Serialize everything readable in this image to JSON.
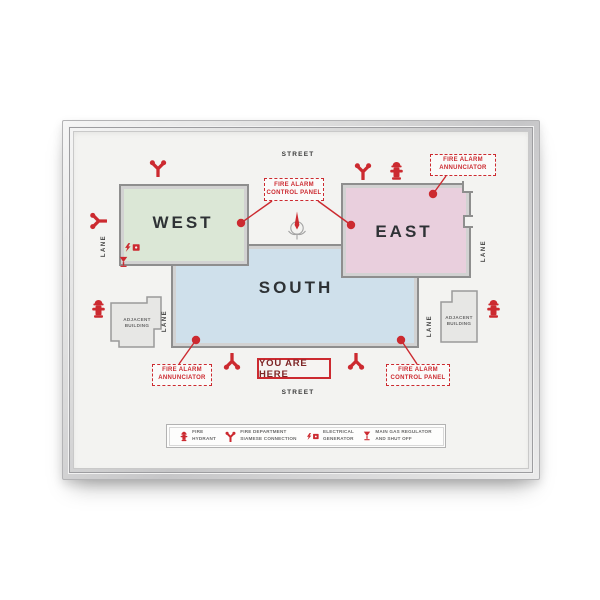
{
  "poster": {
    "streets": {
      "top": "STREET",
      "bottom": "STREET"
    },
    "lane_label": "LANE",
    "buildings": {
      "west": "WEST",
      "east": "EAST",
      "south": "SOUTH",
      "adjacent": [
        "ADJACENT",
        "BUILDING"
      ]
    },
    "callouts": {
      "control_panel": [
        "FIRE ALARM",
        "CONTROL PANEL"
      ],
      "annunciator": [
        "FIRE ALARM",
        "ANNUNCIATOR"
      ],
      "you_are_here": "YOU ARE HERE"
    },
    "legend": {
      "items": [
        {
          "icon": "fire-hydrant-icon",
          "lines": [
            "FIRE",
            "HYDRANT"
          ]
        },
        {
          "icon": "siamese-connection-icon",
          "lines": [
            "FIRE DEPARTMENT",
            "SIAMESE CONNECTION"
          ]
        },
        {
          "icon": "electrical-generator-icon",
          "lines": [
            "ELECTRICAL",
            "GENERATOR"
          ]
        },
        {
          "icon": "gas-regulator-icon",
          "lines": [
            "MAIN GAS REGULATOR",
            "AND SHUT OFF"
          ]
        }
      ]
    },
    "colors": {
      "red": "#cc2a30",
      "west-fill": "#dbe7d6",
      "east-fill": "#e9cfdd",
      "south-fill": "#cfe0eb",
      "adjacent-fill": "#e7e7e5",
      "wall-gray": "#8e8e8e",
      "text-dark": "#2e3235"
    }
  }
}
